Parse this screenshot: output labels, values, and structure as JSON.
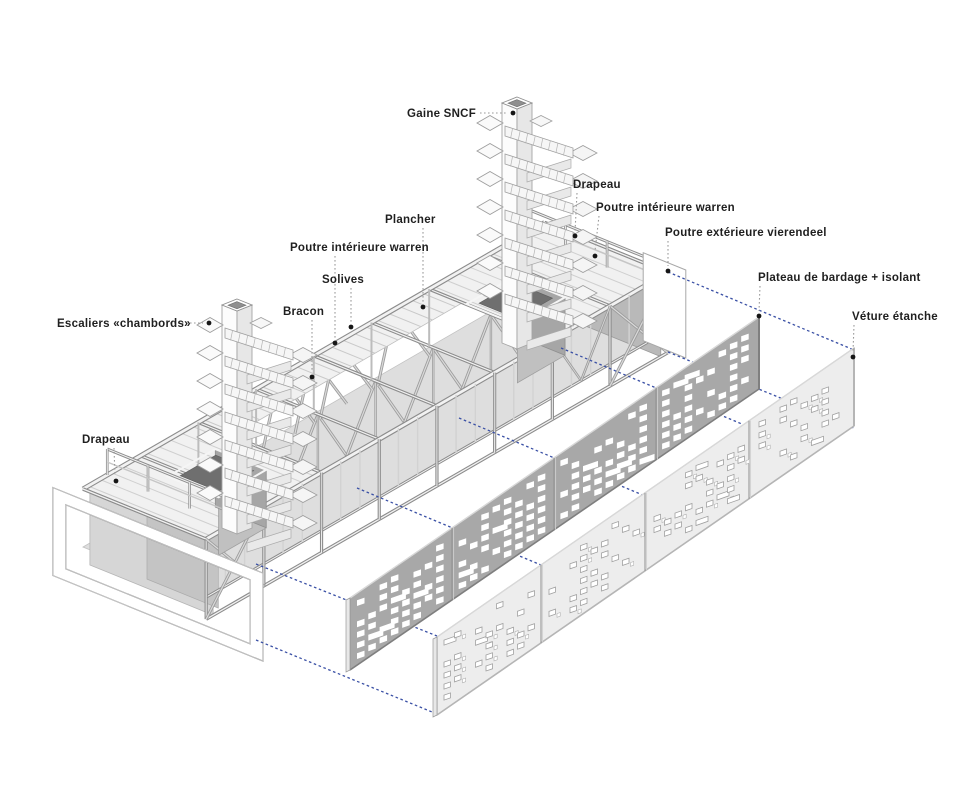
{
  "figure": {
    "kind": "exploded axonometric construction diagram",
    "language": "fr"
  },
  "colors": {
    "background": "#ffffff",
    "accent_blue": "#3a50a5",
    "leader_gray": "#9a9a9a",
    "dot_black": "#161616",
    "label_text": "#1f1f1f",
    "panel_bardage": "#a8a8a8",
    "panel_bardage_edge": "#7f7f7f",
    "panel_veture": "#ededed",
    "panel_veture_edge": "#b5b5b5",
    "frame_light": "#f2f2f2",
    "frame_mid": "#c6c6c6",
    "frame_dark": "#8c8c8c",
    "deck_fill": "#f1f1f1",
    "lower_plane": "#dedede",
    "wall_gray": "#b9b9b9",
    "core_front": "#c0c0c0",
    "core_side": "#a6a6a6",
    "core_hole": "#6f6f6f"
  },
  "labels_map": {
    "gaine_sncf": "Gaine SNCF",
    "drapeau_top": "Drapeau",
    "poutre_interieure_warren_right": "Poutre intérieure warren",
    "poutre_exterieure_vierendeel": "Poutre extérieure vierendeel",
    "plateau_bardage": "Plateau de bardage + isolant",
    "veture_etanche": "Véture étanche",
    "plancher": "Plancher",
    "poutre_interieure_warren_left": "Poutre intérieure warren",
    "solives": "Solives",
    "bracon": "Bracon",
    "escaliers_chambords": "Escaliers «chambords»",
    "drapeau_left": "Drapeau"
  }
}
